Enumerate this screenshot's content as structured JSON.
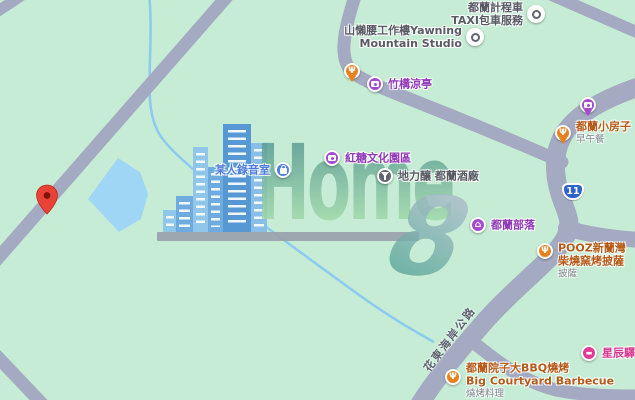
{
  "map_type": "street-map",
  "colors": {
    "background": "#c6ecd5",
    "road": "#a4aac1",
    "water": "#a0d6f5",
    "stream": "#8ccaf0",
    "pin-red": "#ea4335",
    "shield-blue": "#2f63c9"
  },
  "logo": {
    "word": "Home",
    "numeral": "8"
  },
  "route_shield": {
    "number": "11"
  },
  "road_label": {
    "text": "花東海岸公路"
  },
  "pois": [
    {
      "id": "dulan-taxi",
      "icon": "generic-poi-dot",
      "color": "#ffffff",
      "label_color": "#585b63",
      "lines": [
        "都蘭計程車",
        "TAXI包車服務"
      ]
    },
    {
      "id": "yawning-mountain-studio",
      "icon": "generic-poi-dot",
      "color": "#ffffff",
      "label_color": "#585b63",
      "lines": [
        "山懶腰工作樓Yawning",
        "Mountain Studio"
      ]
    },
    {
      "id": "restaurant-pin",
      "icon": "restaurant",
      "color": "#e8821f",
      "label_color": "#b55a17",
      "lines": []
    },
    {
      "id": "bamboo-pavilion",
      "icon": "attraction-camera",
      "color": "#a44bcf",
      "label_color": "#9138b8",
      "lines": [
        "竹構涼亭"
      ]
    },
    {
      "id": "attraction-pin",
      "icon": "attraction-camera",
      "color": "#a44bcf",
      "label_color": "#9138b8",
      "lines": []
    },
    {
      "id": "dulan-small-house",
      "icon": "restaurant",
      "color": "#e8821f",
      "label_color": "#b55a17",
      "lines": [
        "都蘭小房子"
      ],
      "sub": "早午餐"
    },
    {
      "id": "brown-sugar-culture-park",
      "icon": "attraction-camera",
      "color": "#a44bcf",
      "label_color": "#9138b8",
      "lines": [
        "紅糖文化園區"
      ]
    },
    {
      "id": "someones-recording-studio",
      "icon": "shopping-bag",
      "color": "#4b80e1",
      "label_color": "#4c7cd9",
      "lines": [
        "某人錄音室"
      ]
    },
    {
      "id": "dulan-winery",
      "icon": "drink",
      "color": "#61666e",
      "label_color": "#585b63",
      "lines": [
        "地力釀 都蘭酒廠"
      ]
    },
    {
      "id": "dulan-tribe",
      "icon": "village-home",
      "color": "#a44bcf",
      "label_color": "#9138b8",
      "lines": [
        "都蘭部落"
      ]
    },
    {
      "id": "pooz-pizza",
      "icon": "restaurant",
      "color": "#e8821f",
      "label_color": "#b55a17",
      "lines": [
        "POOZ新蘭灣",
        "柴燒窯烤披薩"
      ],
      "sub": "披薩"
    },
    {
      "id": "star-inn",
      "icon": "hotel-bed",
      "color": "#e23a97",
      "label_color": "#d8368f",
      "lines": [
        "星辰驛棧"
      ]
    },
    {
      "id": "big-courtyard-bbq",
      "icon": "restaurant",
      "color": "#e8821f",
      "label_color": "#b55a17",
      "lines": [
        "都蘭院子大BBQ燒烤",
        "Big Courtyard Barbecue"
      ],
      "sub": "燒烤料理"
    }
  ]
}
